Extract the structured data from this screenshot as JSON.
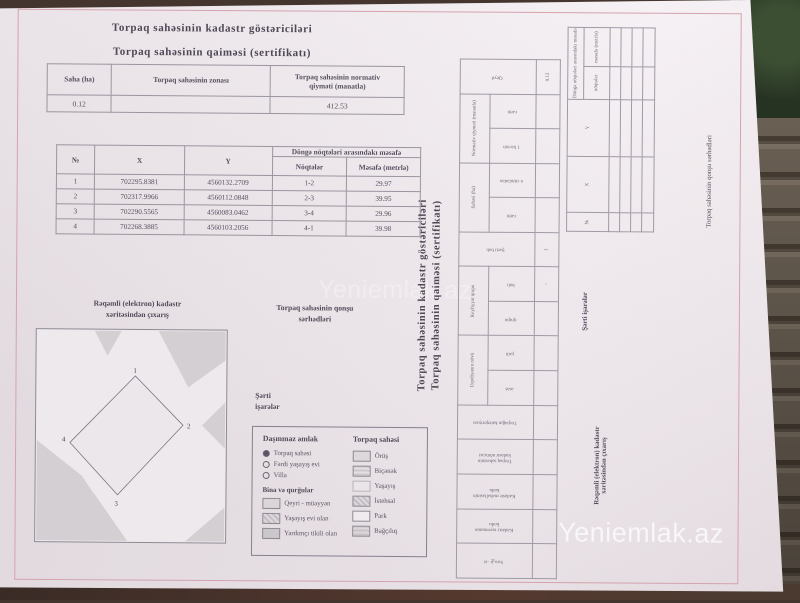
{
  "watermarks": {
    "center": "Yeniemlak.az",
    "bottom_right": "Yeniemlak.az"
  },
  "titles": {
    "line1": "Torpaq sahəsinin kadastr göstəriciləri",
    "line2": "Torpaq sahəsinin qaiməsi (sertifikatı)"
  },
  "summary_table": {
    "col_area": "Saha (ha)",
    "col_zone": "Torpaq sahəsinin zonası",
    "col_value_l1": "Torpaq sahəsinin normativ",
    "col_value_l2": "qiyməti (manatla)",
    "area": "0.12",
    "zone": "",
    "value": "412.53"
  },
  "coords_table": {
    "col_no": "№",
    "col_x": "X",
    "col_y": "Y",
    "group": "Döngə nöqtələri arasındakı məsafə",
    "sub_points": "Nöqtələr",
    "sub_dist": "Məsafə (metrlə)",
    "rows": [
      {
        "no": "1",
        "x": "702295.8381",
        "y": "4560132.2709",
        "pts": "1-2",
        "dist": "29.97"
      },
      {
        "no": "2",
        "x": "702317.9966",
        "y": "4560112.0848",
        "pts": "2-3",
        "dist": "39.95"
      },
      {
        "no": "3",
        "x": "702290.5565",
        "y": "4560083.0462",
        "pts": "3-4",
        "dist": "29.96"
      },
      {
        "no": "4",
        "x": "702268.3885",
        "y": "4560103.2056",
        "pts": "4-1",
        "dist": "39.98"
      }
    ]
  },
  "map": {
    "title_l1": "Rəqəmli (elektron) kadastr",
    "title_l2": "xəritəsindən çıxarış",
    "v1": "1",
    "v2": "2",
    "v3": "3",
    "v4": "4"
  },
  "neighbors": {
    "l1": "Torpaq sahəsinin qonşu",
    "l2": "sərhədləri",
    "full": "Torpaq sahəsinin qonşu sərhədləri"
  },
  "symbols": {
    "l1": "Şərti",
    "l2": "işarələr"
  },
  "legend": {
    "left_header": "Daşınmaz əmlak",
    "radio_items": [
      "Torpaq sahəsi",
      "Fərdi yaşayış evi",
      "Villa"
    ],
    "buildings_header": "Bina və qurğular",
    "building_items": [
      "Qeyri - müəyyən",
      "Yaşayış evi olan",
      "Yardımçı tikili olan"
    ],
    "right_header": "Torpaq sahəsi",
    "right_items": [
      "Örüş",
      "Biçənək",
      "Yaşayış",
      "İstehsal",
      "Park",
      "Bağçılıq"
    ]
  },
  "rotated_page": {
    "title1": "Torpaq sahəsinin kadastr göstəriciləri",
    "title2": "Torpaq sahəsinin qaiməsi (sertifikatı)",
    "indicators_table": {
      "groups": [
        "Sıra №-si",
        "Kadastr rayonunun kodu",
        "Kadastr məhəlləsinin kodu",
        "Torpaq sahəsinin kadastr nömrəsi",
        "Torpağın kateqoriyası",
        "Uqodiyanın növü",
        "Keyfiyyət qrupu",
        "Şərti balı",
        "Sahəsi (ha)",
        "Normativ qiyməti (manatla)",
        "Qeyd"
      ],
      "subs": [
        "əsas",
        "şərti",
        "qrupu",
        "balı",
        "cəmi",
        "o cümlədən",
        "1 ha-nın",
        "cəmi"
      ],
      "values": [
        "",
        "",
        "",
        "",
        "",
        "",
        "",
        "",
        "-",
        "1",
        "",
        "",
        "",
        "",
        "0.12"
      ]
    },
    "coords_table": {
      "col_no": "№",
      "col_x": "X",
      "col_y": "Y",
      "group": "Döngə nöqtələri arasındakı məsafə",
      "sub_points": "nöqtələr",
      "sub_dist": "məsafə (metrlə)"
    },
    "symbols_l1": "Şərti",
    "symbols_l2": "işarələr",
    "map_label_l1": "Rəqəmli (elektron) kadastr",
    "map_label_l2": "xəritəsindən çıxarış",
    "neighbors_label": "Torpaq sahəsinin qonşu sərhədləri"
  },
  "colors": {
    "paper": "#f0eaee",
    "frame_red": "#d5a3ae",
    "map_gray": "#d3cfd2",
    "text": "#554f5c",
    "wood": "#857869",
    "foliage": "#2c3a27"
  }
}
